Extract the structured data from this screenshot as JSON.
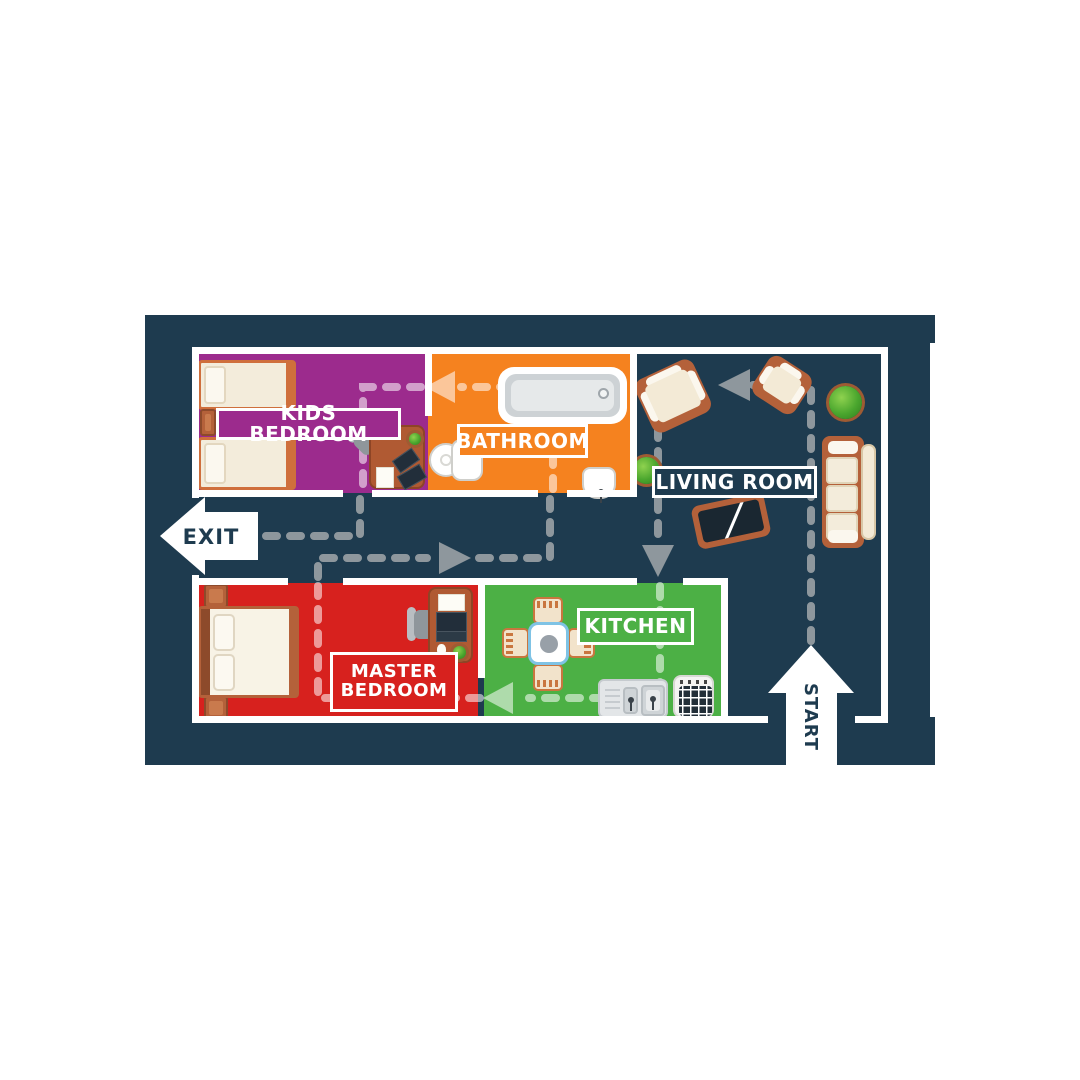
{
  "board": {
    "background_color": "#1e3b4f",
    "wall_color": "#ffffff",
    "route_color_on_floor": "#8e979d",
    "route_color_on_rooms": "rgba(255,255,255,0.55)"
  },
  "rooms": {
    "kids_bedroom": {
      "label": "KIDS BEDROOM",
      "color": "#9c2b8d"
    },
    "bathroom": {
      "label": "BATHROOM",
      "color": "#f5821f"
    },
    "living_room": {
      "label": "LIVING ROOM",
      "color": "#1e3b4f"
    },
    "master_bedroom": {
      "label_line1": "MASTER",
      "label_line2": "BEDROOM",
      "color": "#d7211e"
    },
    "kitchen": {
      "label": "KITCHEN",
      "color": "#4cb045"
    }
  },
  "markers": {
    "exit_label": "EXIT",
    "start_label": "START"
  }
}
